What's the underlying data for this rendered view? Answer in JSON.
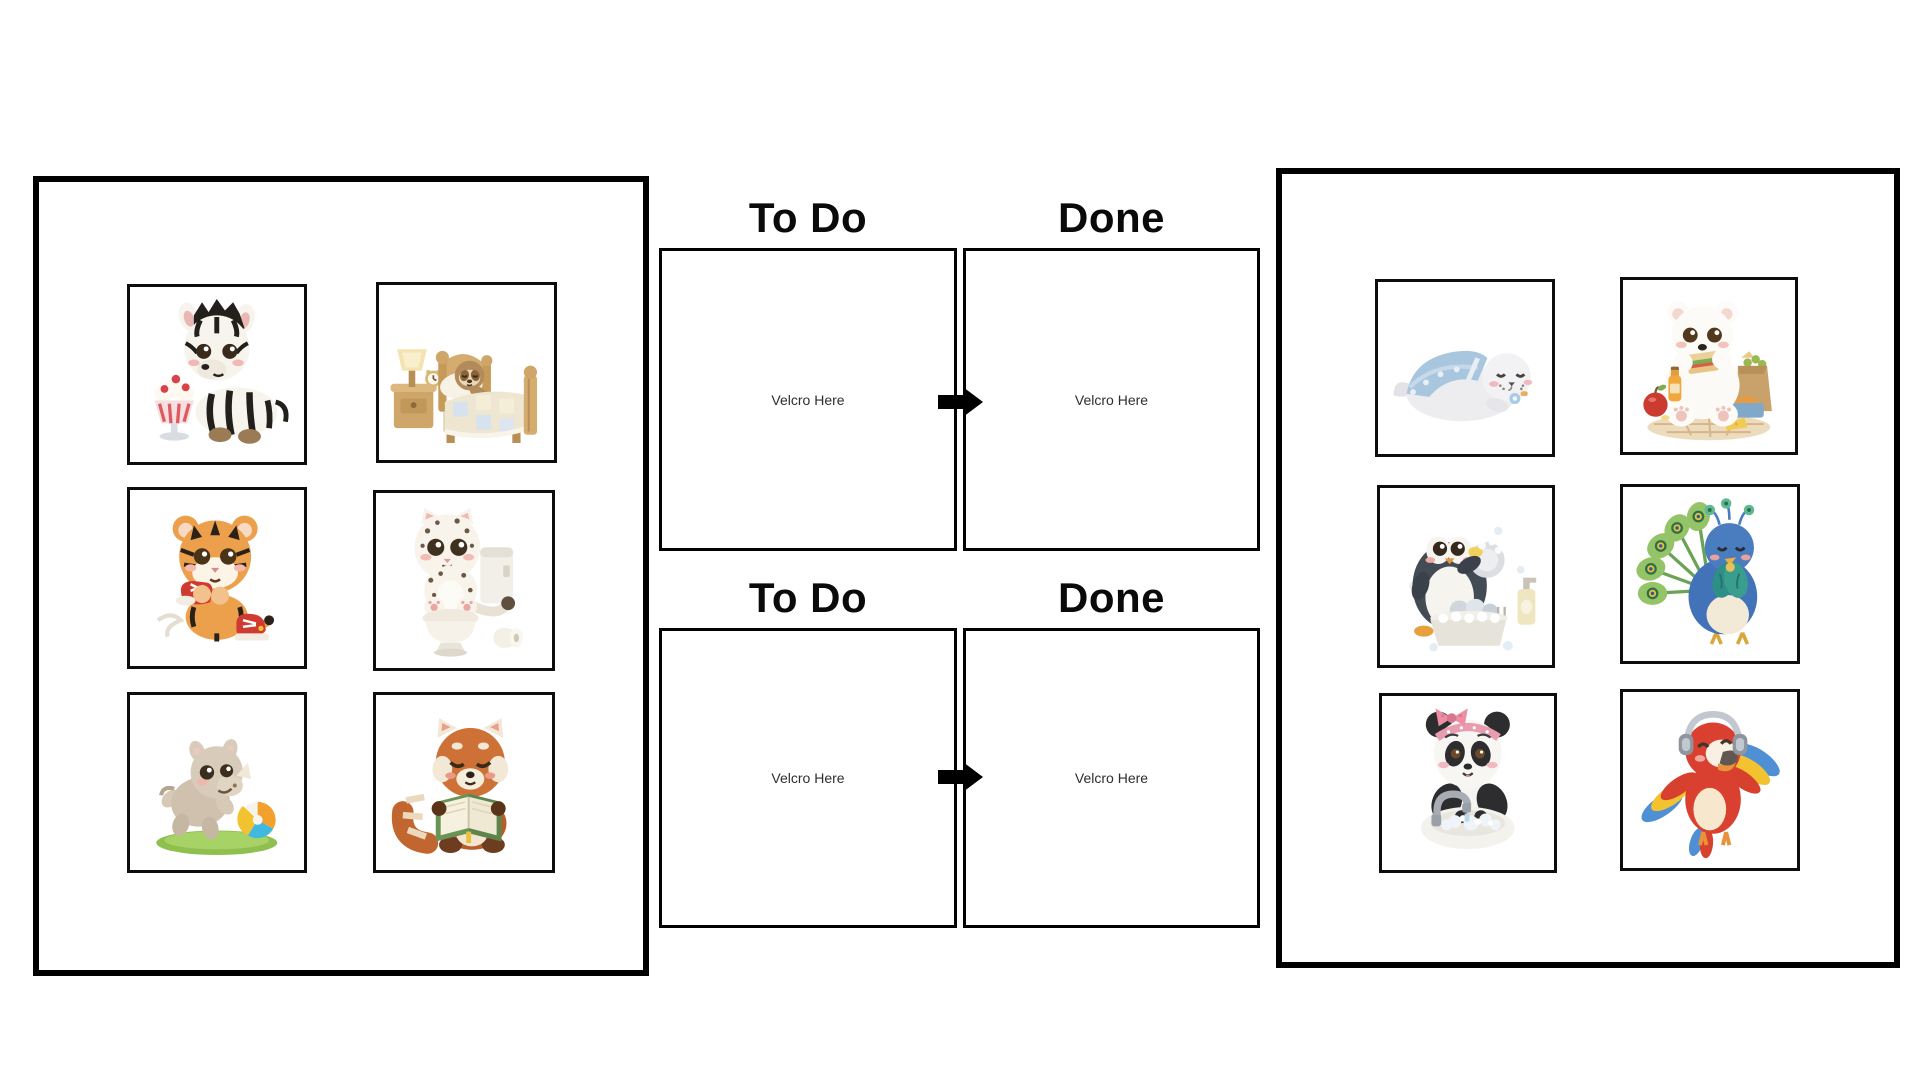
{
  "document": {
    "kind": "printable visual task chart",
    "background": "#ffffff"
  },
  "colors": {
    "board_border": "#000000",
    "card_border": "#0d0d0d",
    "box_border": "#000000",
    "title_text": "#0a0a0a",
    "velcro_text": "#2e2e2e",
    "arrow": "#000000",
    "background": "#ffffff"
  },
  "flows": [
    {
      "todo_title": "To Do",
      "done_title": "Done",
      "todo_velcro": "Velcro Here",
      "done_velcro": "Velcro Here",
      "arrow_icon": "right-arrow-icon"
    },
    {
      "todo_title": "To Do",
      "done_title": "Done",
      "todo_velcro": "Velcro Here",
      "done_velcro": "Velcro Here",
      "arrow_icon": "right-arrow-icon"
    }
  ],
  "left_board": {
    "cards": [
      {
        "icon": "zebra-eating-ice-cream-illustration"
      },
      {
        "icon": "sloth-sleeping-in-bed-illustration"
      },
      {
        "icon": "tiger-tying-shoes-illustration"
      },
      {
        "icon": "snow-leopard-on-toilet-illustration"
      },
      {
        "icon": "rhino-playing-with-ball-illustration"
      },
      {
        "icon": "red-panda-reading-book-illustration"
      }
    ]
  },
  "right_board": {
    "cards": [
      {
        "icon": "seal-sleeping-under-blanket-illustration"
      },
      {
        "icon": "polar-bear-eating-lunch-illustration"
      },
      {
        "icon": "penguin-washing-dishes-illustration"
      },
      {
        "icon": "peacock-resting-quietly-illustration"
      },
      {
        "icon": "panda-washing-hands-illustration"
      },
      {
        "icon": "parrot-listening-music-illustration"
      }
    ]
  }
}
